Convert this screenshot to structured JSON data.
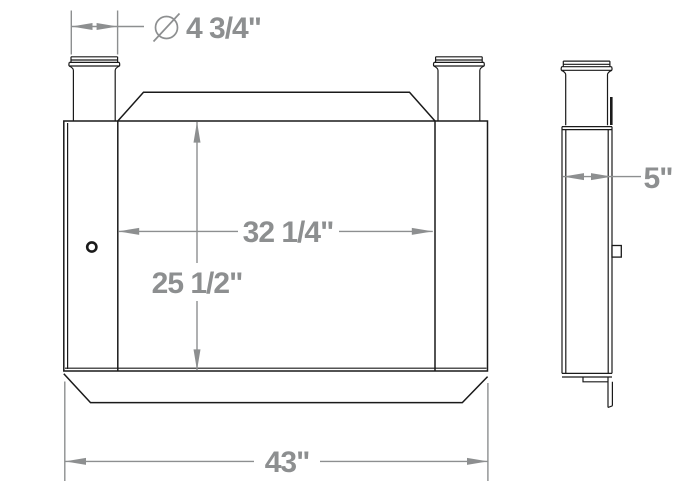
{
  "drawing": {
    "background": "#ffffff",
    "line_color": "#1a1a1a",
    "dimension_color": "#8d8f90",
    "views": {
      "front": "front-view",
      "side": "side-view"
    },
    "icons": {
      "diameter_symbol_icon": "⌀"
    },
    "dimensions": {
      "neck_diameter": "4 3/4\"",
      "core_width": "32 1/4\"",
      "core_height": "25 1/2\"",
      "overall_width": "43\"",
      "depth": "5\""
    }
  }
}
